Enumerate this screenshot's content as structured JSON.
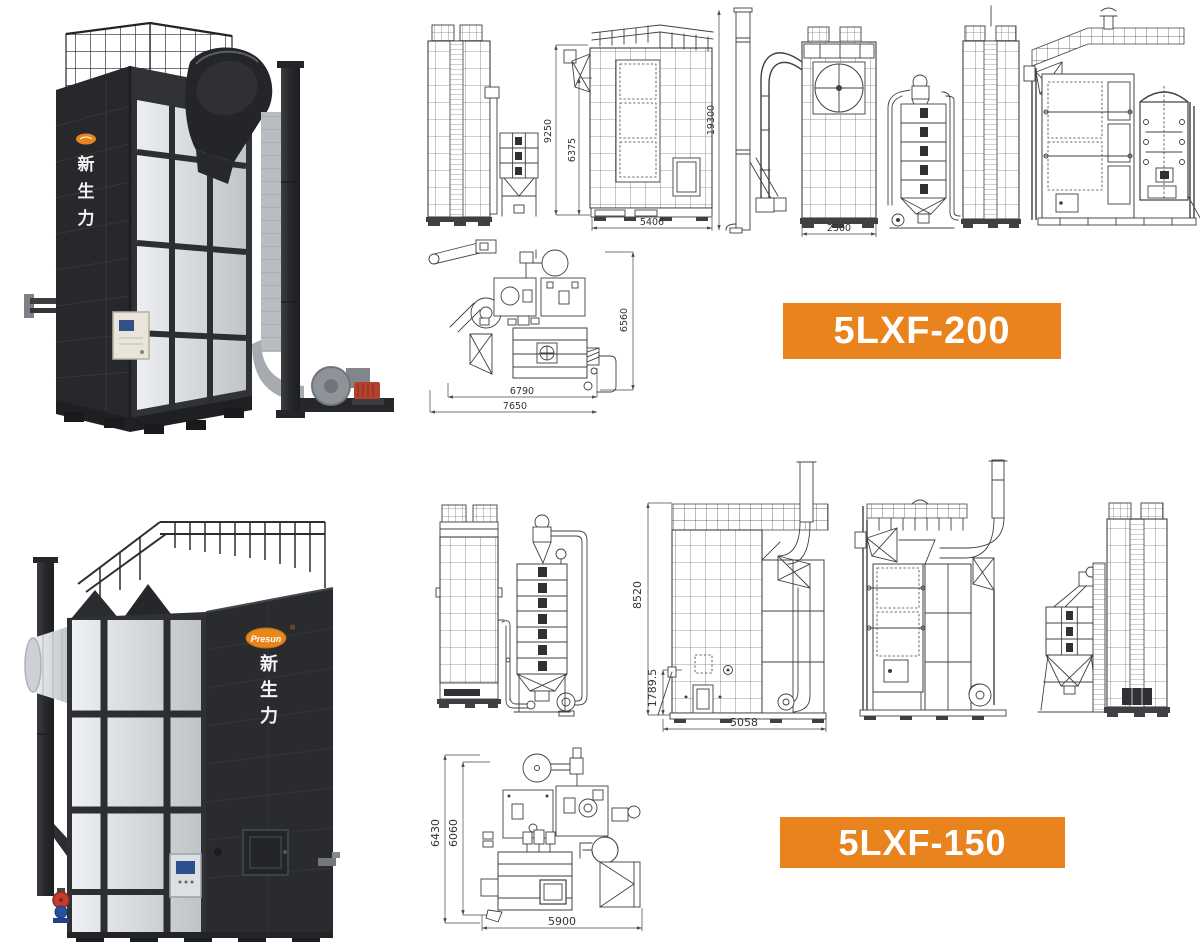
{
  "page": {
    "background": "#ffffff"
  },
  "brand": {
    "logo_text": "Presun",
    "registered_mark": "®",
    "vertical_name": [
      "新",
      "生",
      "力"
    ],
    "accent": "#e8831d"
  },
  "sections": [
    {
      "model_label": "5LXF-200",
      "dims": {
        "front_height": "9250",
        "column_height": "6375",
        "body_width": "5406",
        "exhaust_pipe_height": "19300",
        "rear_width": "2500",
        "plan_depth": "6560",
        "plan_length_inner": "6790",
        "plan_length_total": "7650"
      }
    },
    {
      "model_label": "5LXF-150",
      "dims": {
        "side_height": "8520",
        "base_height": "1789.5",
        "body_width": "5058",
        "plan_depth_total": "6430",
        "plan_depth_inner": "6060",
        "plan_length": "5900"
      }
    }
  ]
}
